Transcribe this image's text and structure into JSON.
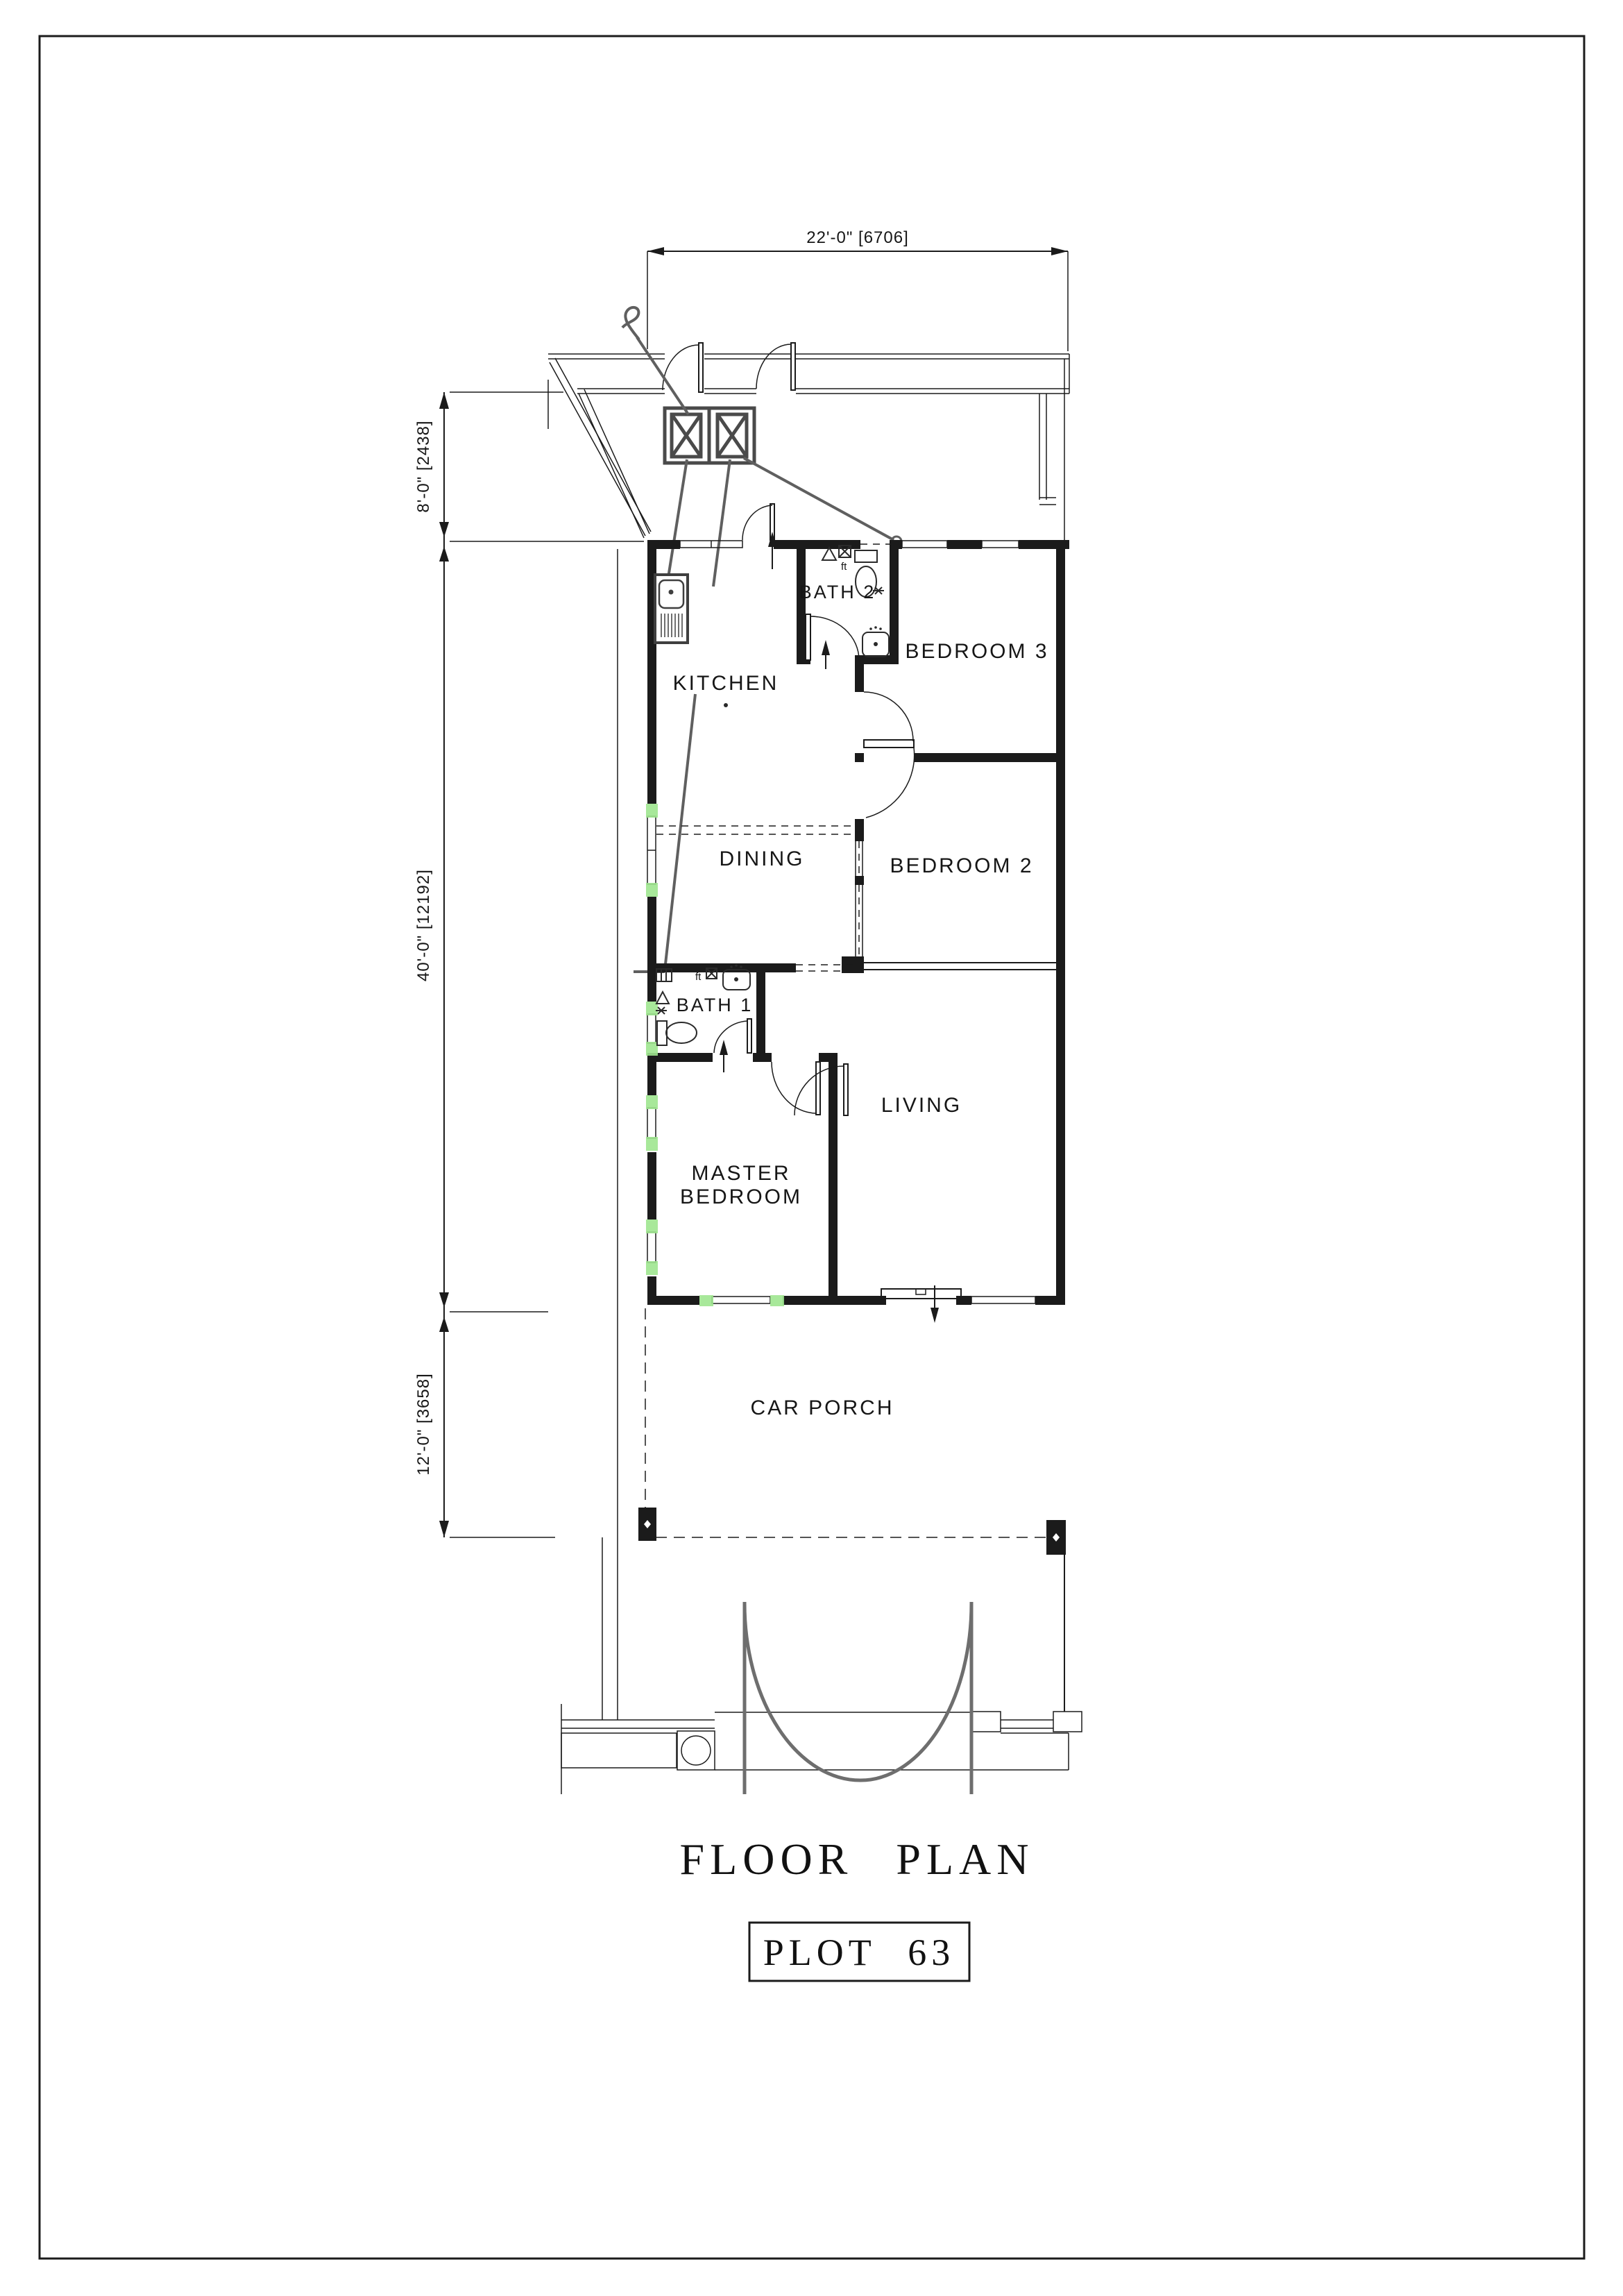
{
  "sheet": {
    "title": "FLOOR PLAN",
    "plot_label": "PLOT 63"
  },
  "dimensions": {
    "top_width": "22'-0\" [6706]",
    "left_rear_setback": "8'-0\" [2438]",
    "left_house_depth": "40'-0\" [12192]",
    "left_porch_depth": "12'-0\" [3658]"
  },
  "rooms": {
    "kitchen": "KITCHEN",
    "bath2": "BATH 2",
    "bedroom3": "BEDROOM 3",
    "dining": "DINING",
    "bedroom2": "BEDROOM 2",
    "bath1": "BATH 1",
    "living": "LIVING",
    "master_line1": "MASTER",
    "master_line2": "BEDROOM",
    "car_porch": "CAR PORCH"
  },
  "annotations": {
    "floor_trap_bath2": "ft",
    "floor_trap_bath1": "ft"
  },
  "colors": {
    "line": "#1b1b1b",
    "leader_gray": "#5f5f5f",
    "gate_gray": "#6e6e6e",
    "window_highlight": "#9fe58f",
    "paper": "#ffffff"
  }
}
